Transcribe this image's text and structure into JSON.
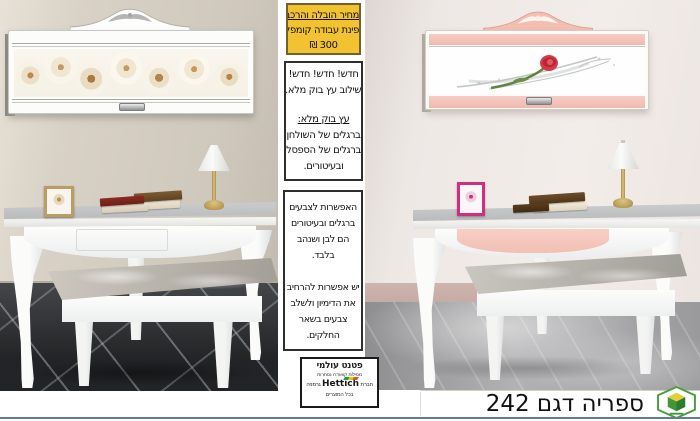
{
  "colors": {
    "highlight_yellow": "#F2C231",
    "accent_pink": "#F3C0B5",
    "footer_line_blue": "#5E7F93",
    "logo_green": "#44953A"
  },
  "price_box": {
    "line1": "מחיר הובלה והרכבה",
    "line2": "פינת עבודה קומפלט",
    "line3": "300 ₪"
  },
  "new_box": {
    "line1": "חדש! חדש! חדש!",
    "line2": "שילוב עץ בוק מלא.",
    "heading": "עץ בוק מלא:",
    "line3": "ברגלים של השולחן",
    "line4": "ברגלים של הספסל",
    "line5": "ובעיטורים."
  },
  "options_box": {
    "p1l1": "האפשרות לצבעים",
    "p1l2": "ברגלים ובעיטורים",
    "p1l3": "הם לבן ושנהב",
    "p1l4": "בלבד.",
    "p2l1": "יש אפשרות להרחיב",
    "p2l2": "את הדימיון ולשלב",
    "p2l3": "צבעים בשאר",
    "p2l4": "החלקים."
  },
  "patent_box": {
    "title": "פטנט עולמי",
    "subtitle": "מסילות קוואדרו נסתרות",
    "company_prefix": "חברת",
    "brand": "Hettich",
    "company_suffix": "גרמניה",
    "footer": "בכל המוצרים"
  },
  "footer": {
    "product_title": "ספריה דגם 242"
  }
}
